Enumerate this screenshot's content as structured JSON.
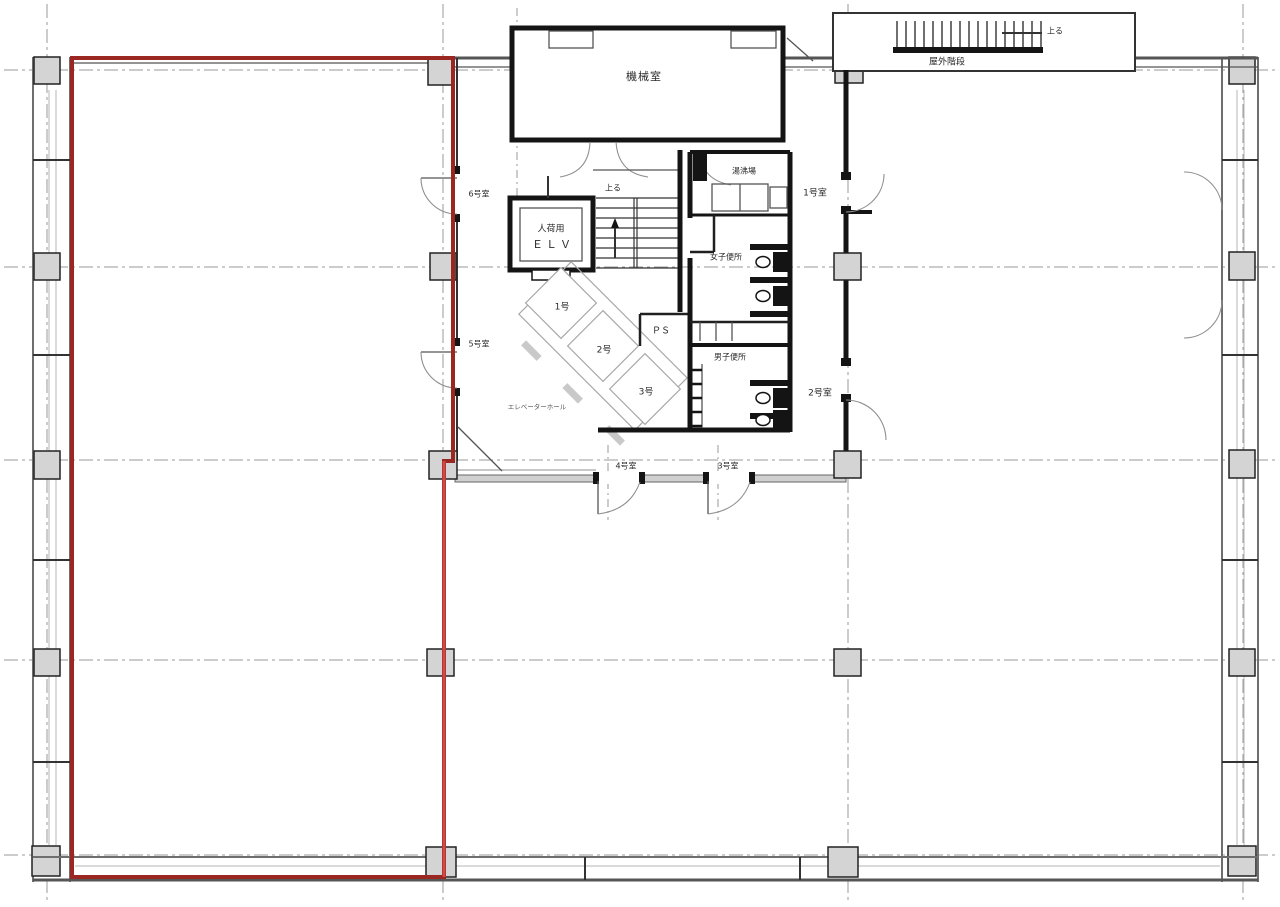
{
  "plan": {
    "title": "office-floor-plan",
    "labels": {
      "machine_room": "機械室",
      "outdoor_stair": "屋外階段",
      "up_outdoor": "上る",
      "up_stair": "上る",
      "elv_line1": "人荷用",
      "elv_line2": "ＥＬＶ",
      "hot_water": "湯沸場",
      "womens_toilet": "女子便所",
      "mens_toilet": "男子便所",
      "ps": "ＰＳ",
      "elevator_hall": "エレベーターホール",
      "room1": "1号室",
      "room2": "2号室",
      "room3": "3号室",
      "room4": "4号室",
      "room5": "5号室",
      "room6": "6号室",
      "car1": "1号",
      "car2": "2号",
      "car3": "3号"
    },
    "colors": {
      "lease_outline_dark": "#9b2723",
      "lease_outline_bright": "#d24a45",
      "wall": "#141414",
      "column_fill": "#d4d4d4",
      "grid": "#9a9a9a"
    }
  }
}
